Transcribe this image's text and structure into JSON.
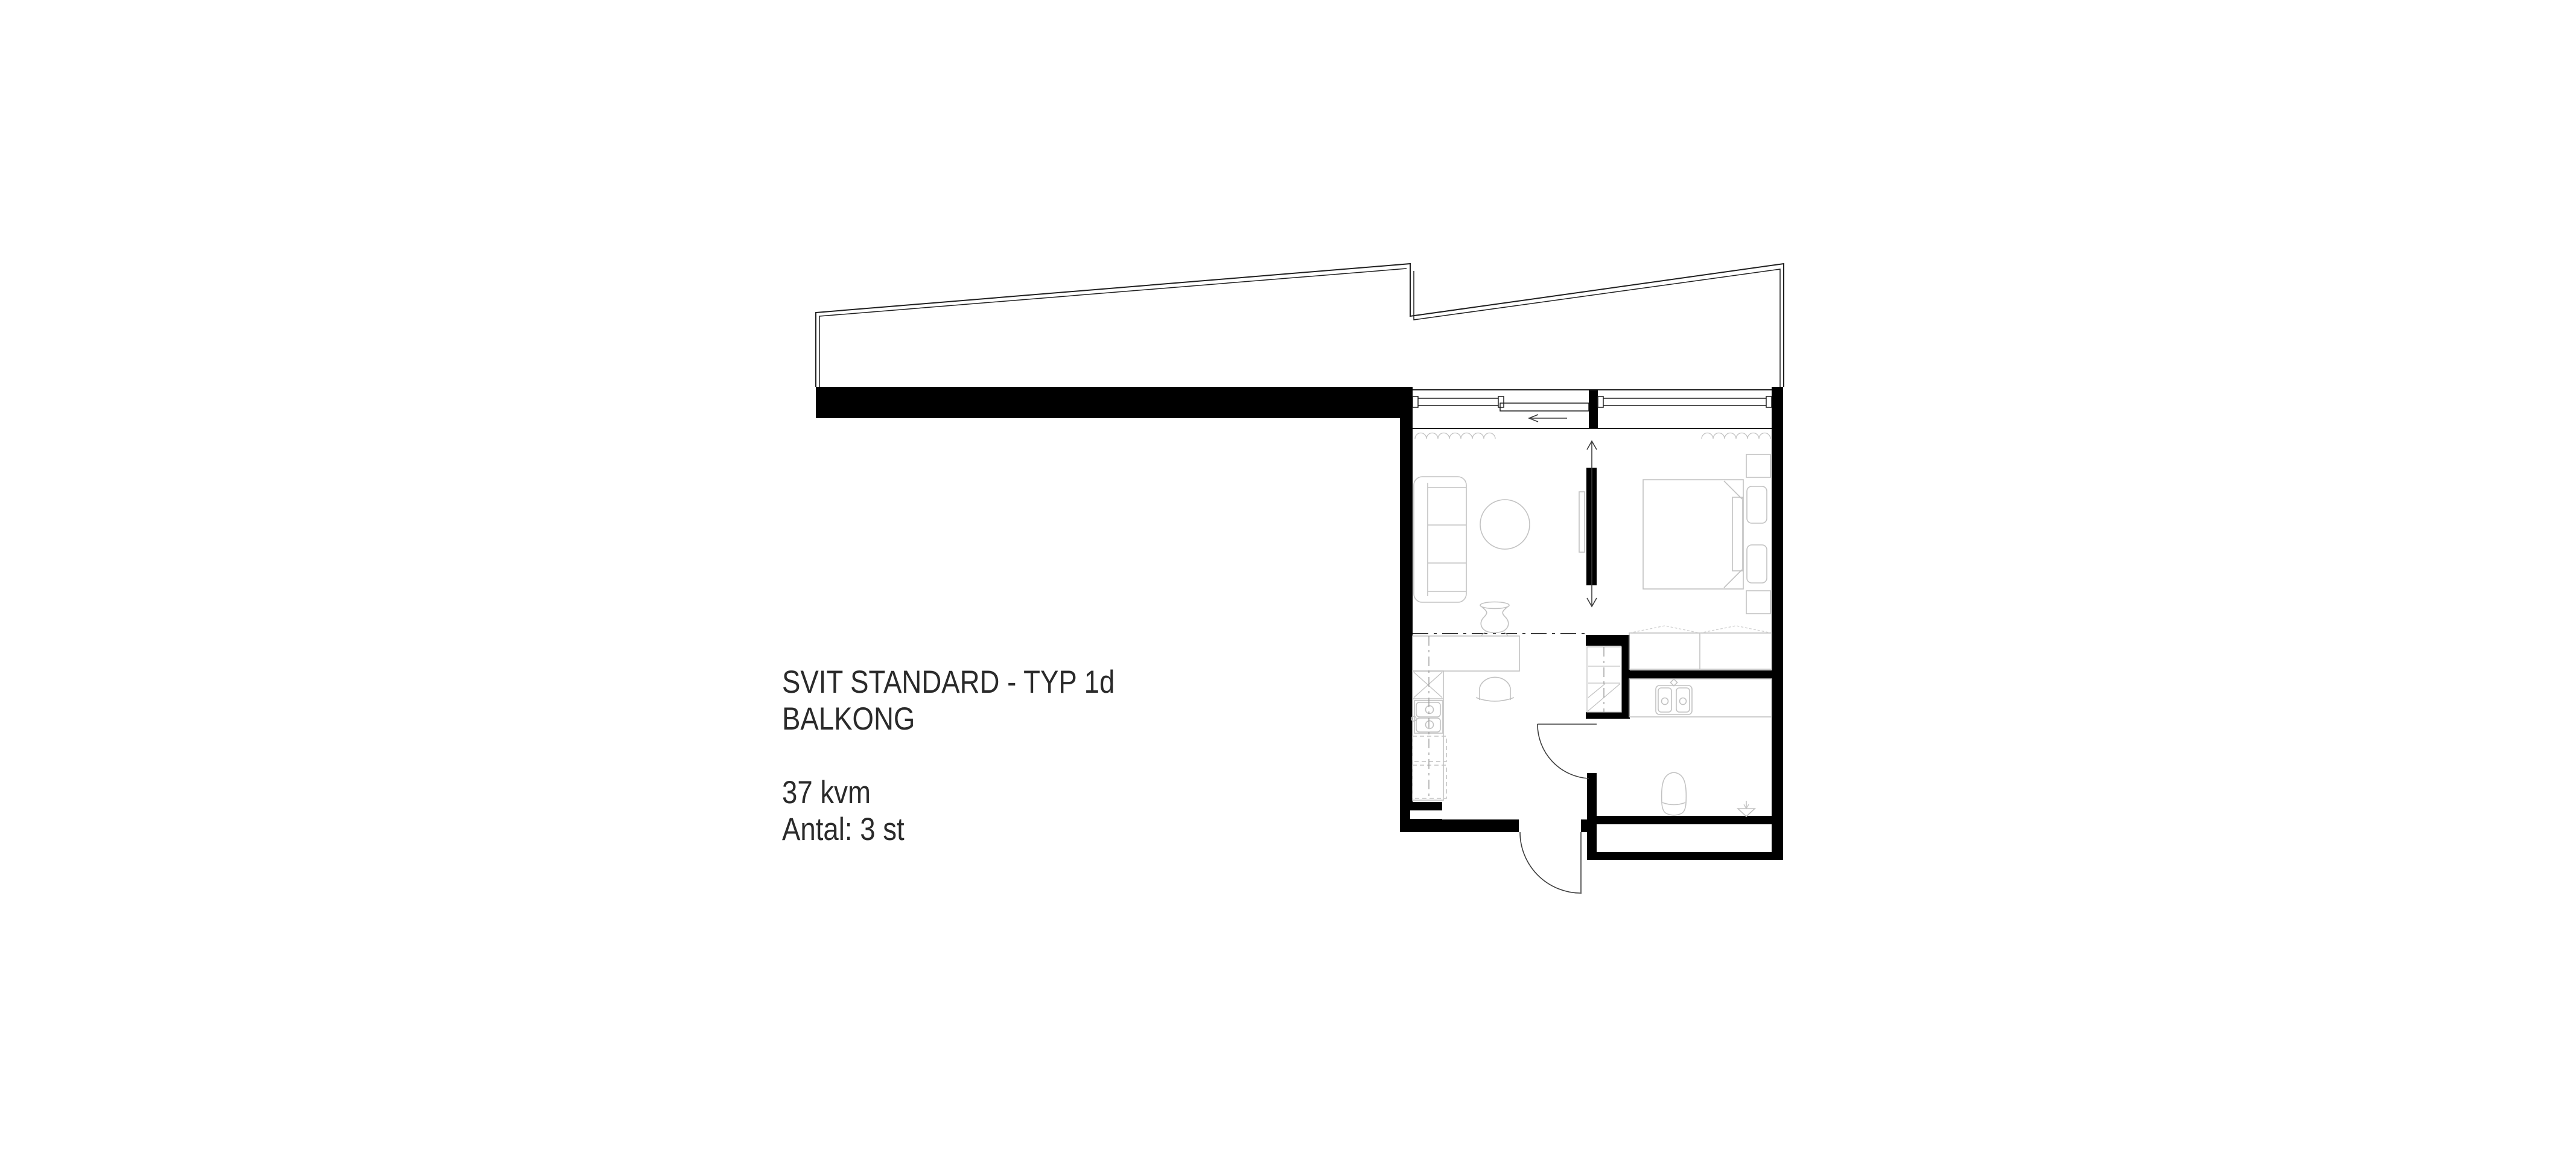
{
  "label": {
    "title_line1": "SVIT STANDARD - TYP 1d",
    "title_line2": "BALKONG",
    "area": "37 kvm",
    "quantity": "Antal: 3 st"
  },
  "colors": {
    "background": "#ffffff",
    "wall": "#000000",
    "line": "#1f1f1f",
    "furniture": "#c2c2c2",
    "detail": "#3c3c3c",
    "text": "#2a2a2a"
  }
}
